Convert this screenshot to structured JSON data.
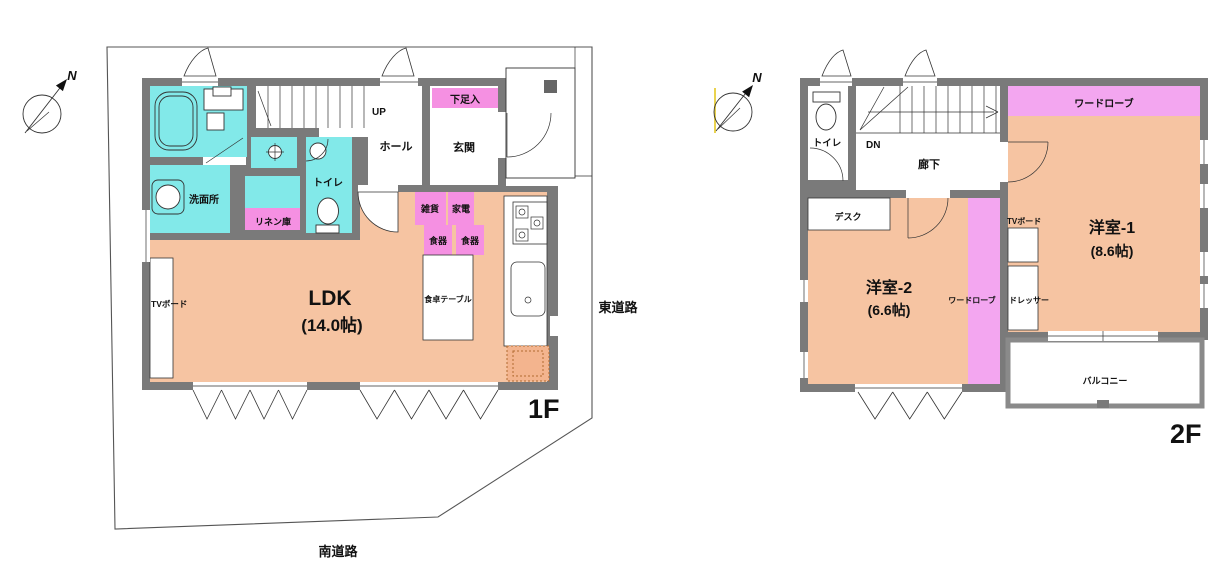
{
  "plans": {
    "f1": {
      "floor_label": "1F",
      "compass_n": "N",
      "road_east": "東道路",
      "road_south": "南道路",
      "stairs": "UP",
      "hall": "ホール",
      "entrance": "玄関",
      "shoe_cabinet": "下足入",
      "washroom": "洗面所",
      "toilet": "トイレ",
      "linen": "リネン庫",
      "goods": "雑貨",
      "appliance": "家電",
      "dish1": "食器",
      "dish2": "食器",
      "dining_table": "食卓テーブル",
      "tv_board": "TVボード",
      "ldk": "LDK",
      "ldk_size": "(14.0帖)"
    },
    "f2": {
      "floor_label": "2F",
      "compass_n": "N",
      "stairs": "DN",
      "toilet": "トイレ",
      "corridor": "廊下",
      "desk": "デスク",
      "room1": "洋室-1",
      "room1_size": "(8.6帖)",
      "room2": "洋室-2",
      "room2_size": "(6.6帖)",
      "wardrobe_top": "ワードローブ",
      "wardrobe_side": "ワードローブ",
      "tv_board": "TVボード",
      "dresser": "ドレッサー",
      "balcony": "バルコニー"
    }
  },
  "colors": {
    "wall": "#7a7a7a",
    "wet_room": "#82e9e9",
    "warm_room": "#f6c4a2",
    "storage_pink": "#f590e2",
    "wardrobe_pink": "#f3a6f0",
    "hatch_fill": "#f3b48e"
  }
}
